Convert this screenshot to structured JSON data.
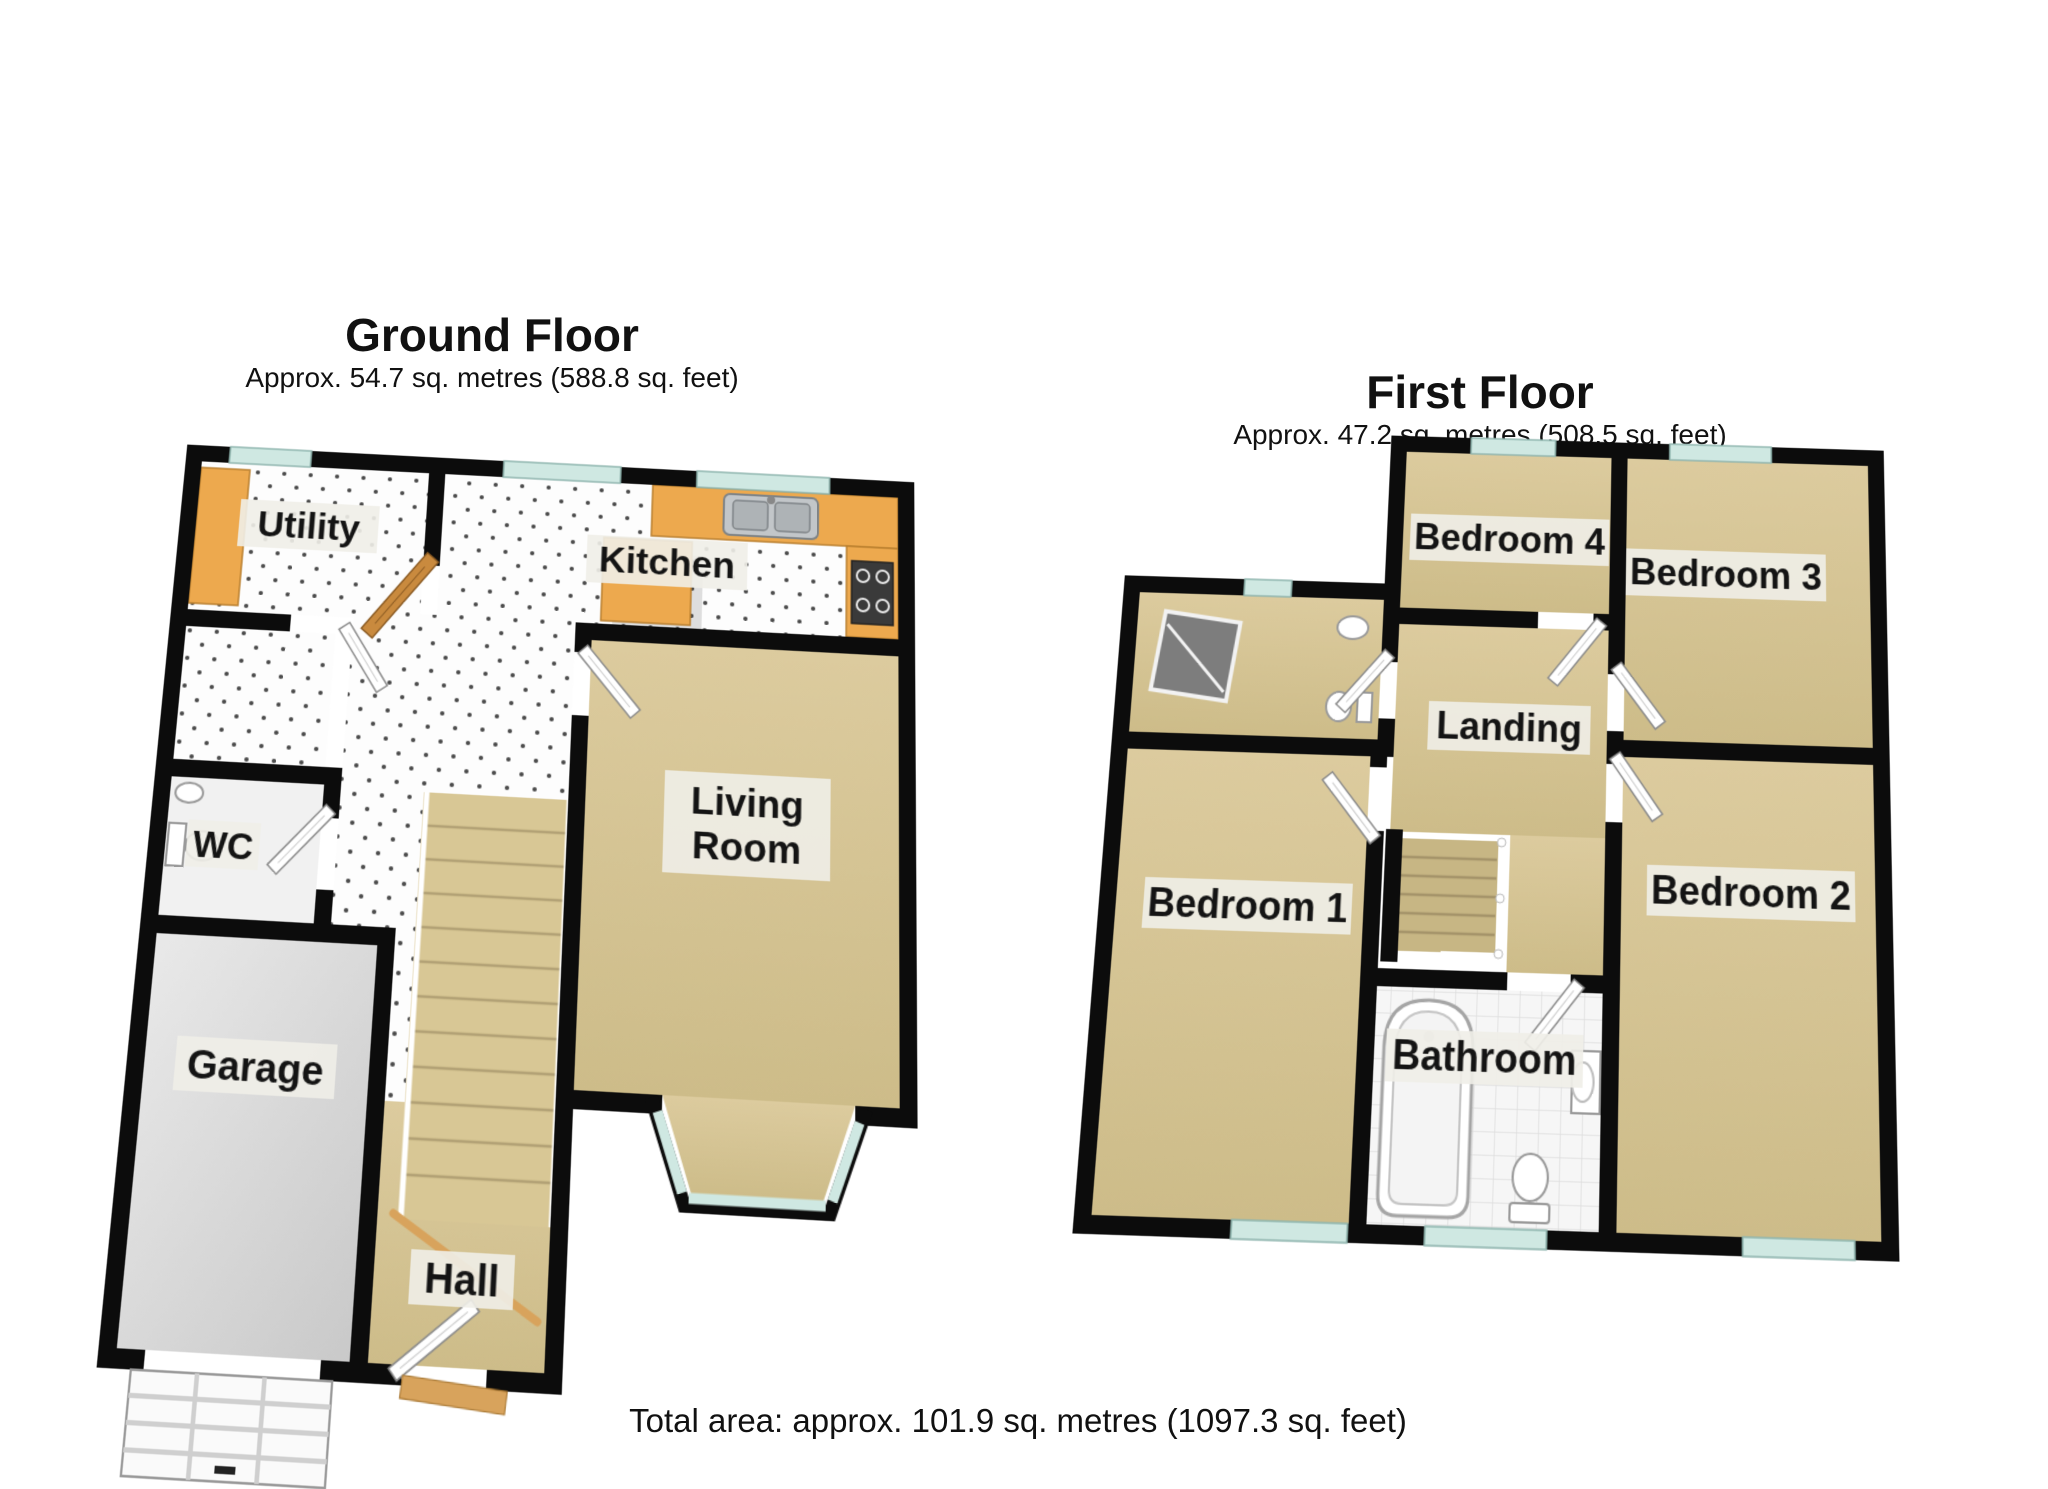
{
  "ground_floor": {
    "title": "Ground Floor",
    "subtitle": "Approx. 54.7 sq. metres (588.8 sq. feet)",
    "rooms": {
      "utility": "Utility",
      "kitchen": "Kitchen",
      "wc": "WC",
      "garage": "Garage",
      "hall": "Hall",
      "living_line1": "Living",
      "living_line2": "Room"
    }
  },
  "first_floor": {
    "title": "First Floor",
    "subtitle": "Approx. 47.2 sq. metres (508.5 sq. feet)",
    "rooms": {
      "bedroom4": "Bedroom 4",
      "bedroom3": "Bedroom 3",
      "landing": "Landing",
      "bedroom1": "Bedroom 1",
      "bedroom2": "Bedroom 2",
      "bathroom": "Bathroom"
    }
  },
  "footer": {
    "total_area": "Total area: approx. 101.9 sq. metres (1097.3 sq. feet)"
  },
  "colors": {
    "wall": "#0c0c0c",
    "carpet": "#d5c493",
    "tile_floor": "#fdfdfd",
    "concrete": "#d9d9d9",
    "window_glass": "#cfe8e2",
    "wood": "#e0a85a",
    "counter_wood": "#eda94e"
  }
}
